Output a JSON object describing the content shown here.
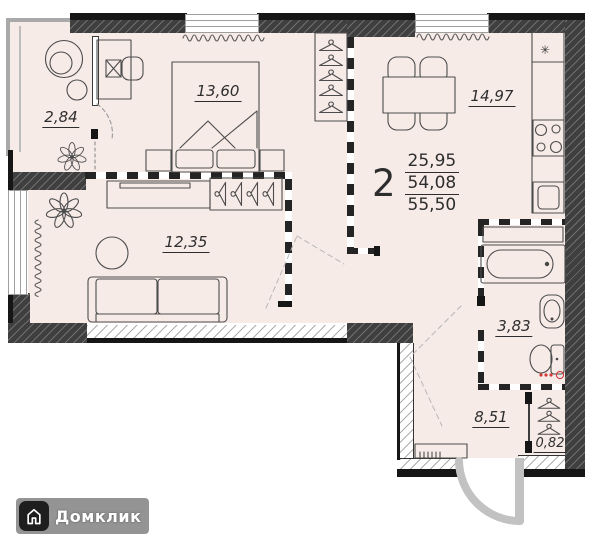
{
  "plan": {
    "summary": {
      "rooms_count": "2",
      "living_area": "25,95",
      "apartment_area": "54,08",
      "total_area": "55,50"
    },
    "rooms": {
      "loggia": "2,84",
      "bedroom": "13,60",
      "kitchen": "14,97",
      "living": "12,35",
      "bathroom": "3,83",
      "hallway": "8,51",
      "closet": "0,82"
    },
    "vent": "✳"
  },
  "branding": {
    "name": "Домклик"
  },
  "colors": {
    "floor": "#f7ebe8",
    "wall": "#3f3f3f",
    "accent_red": "#d23b3b"
  }
}
